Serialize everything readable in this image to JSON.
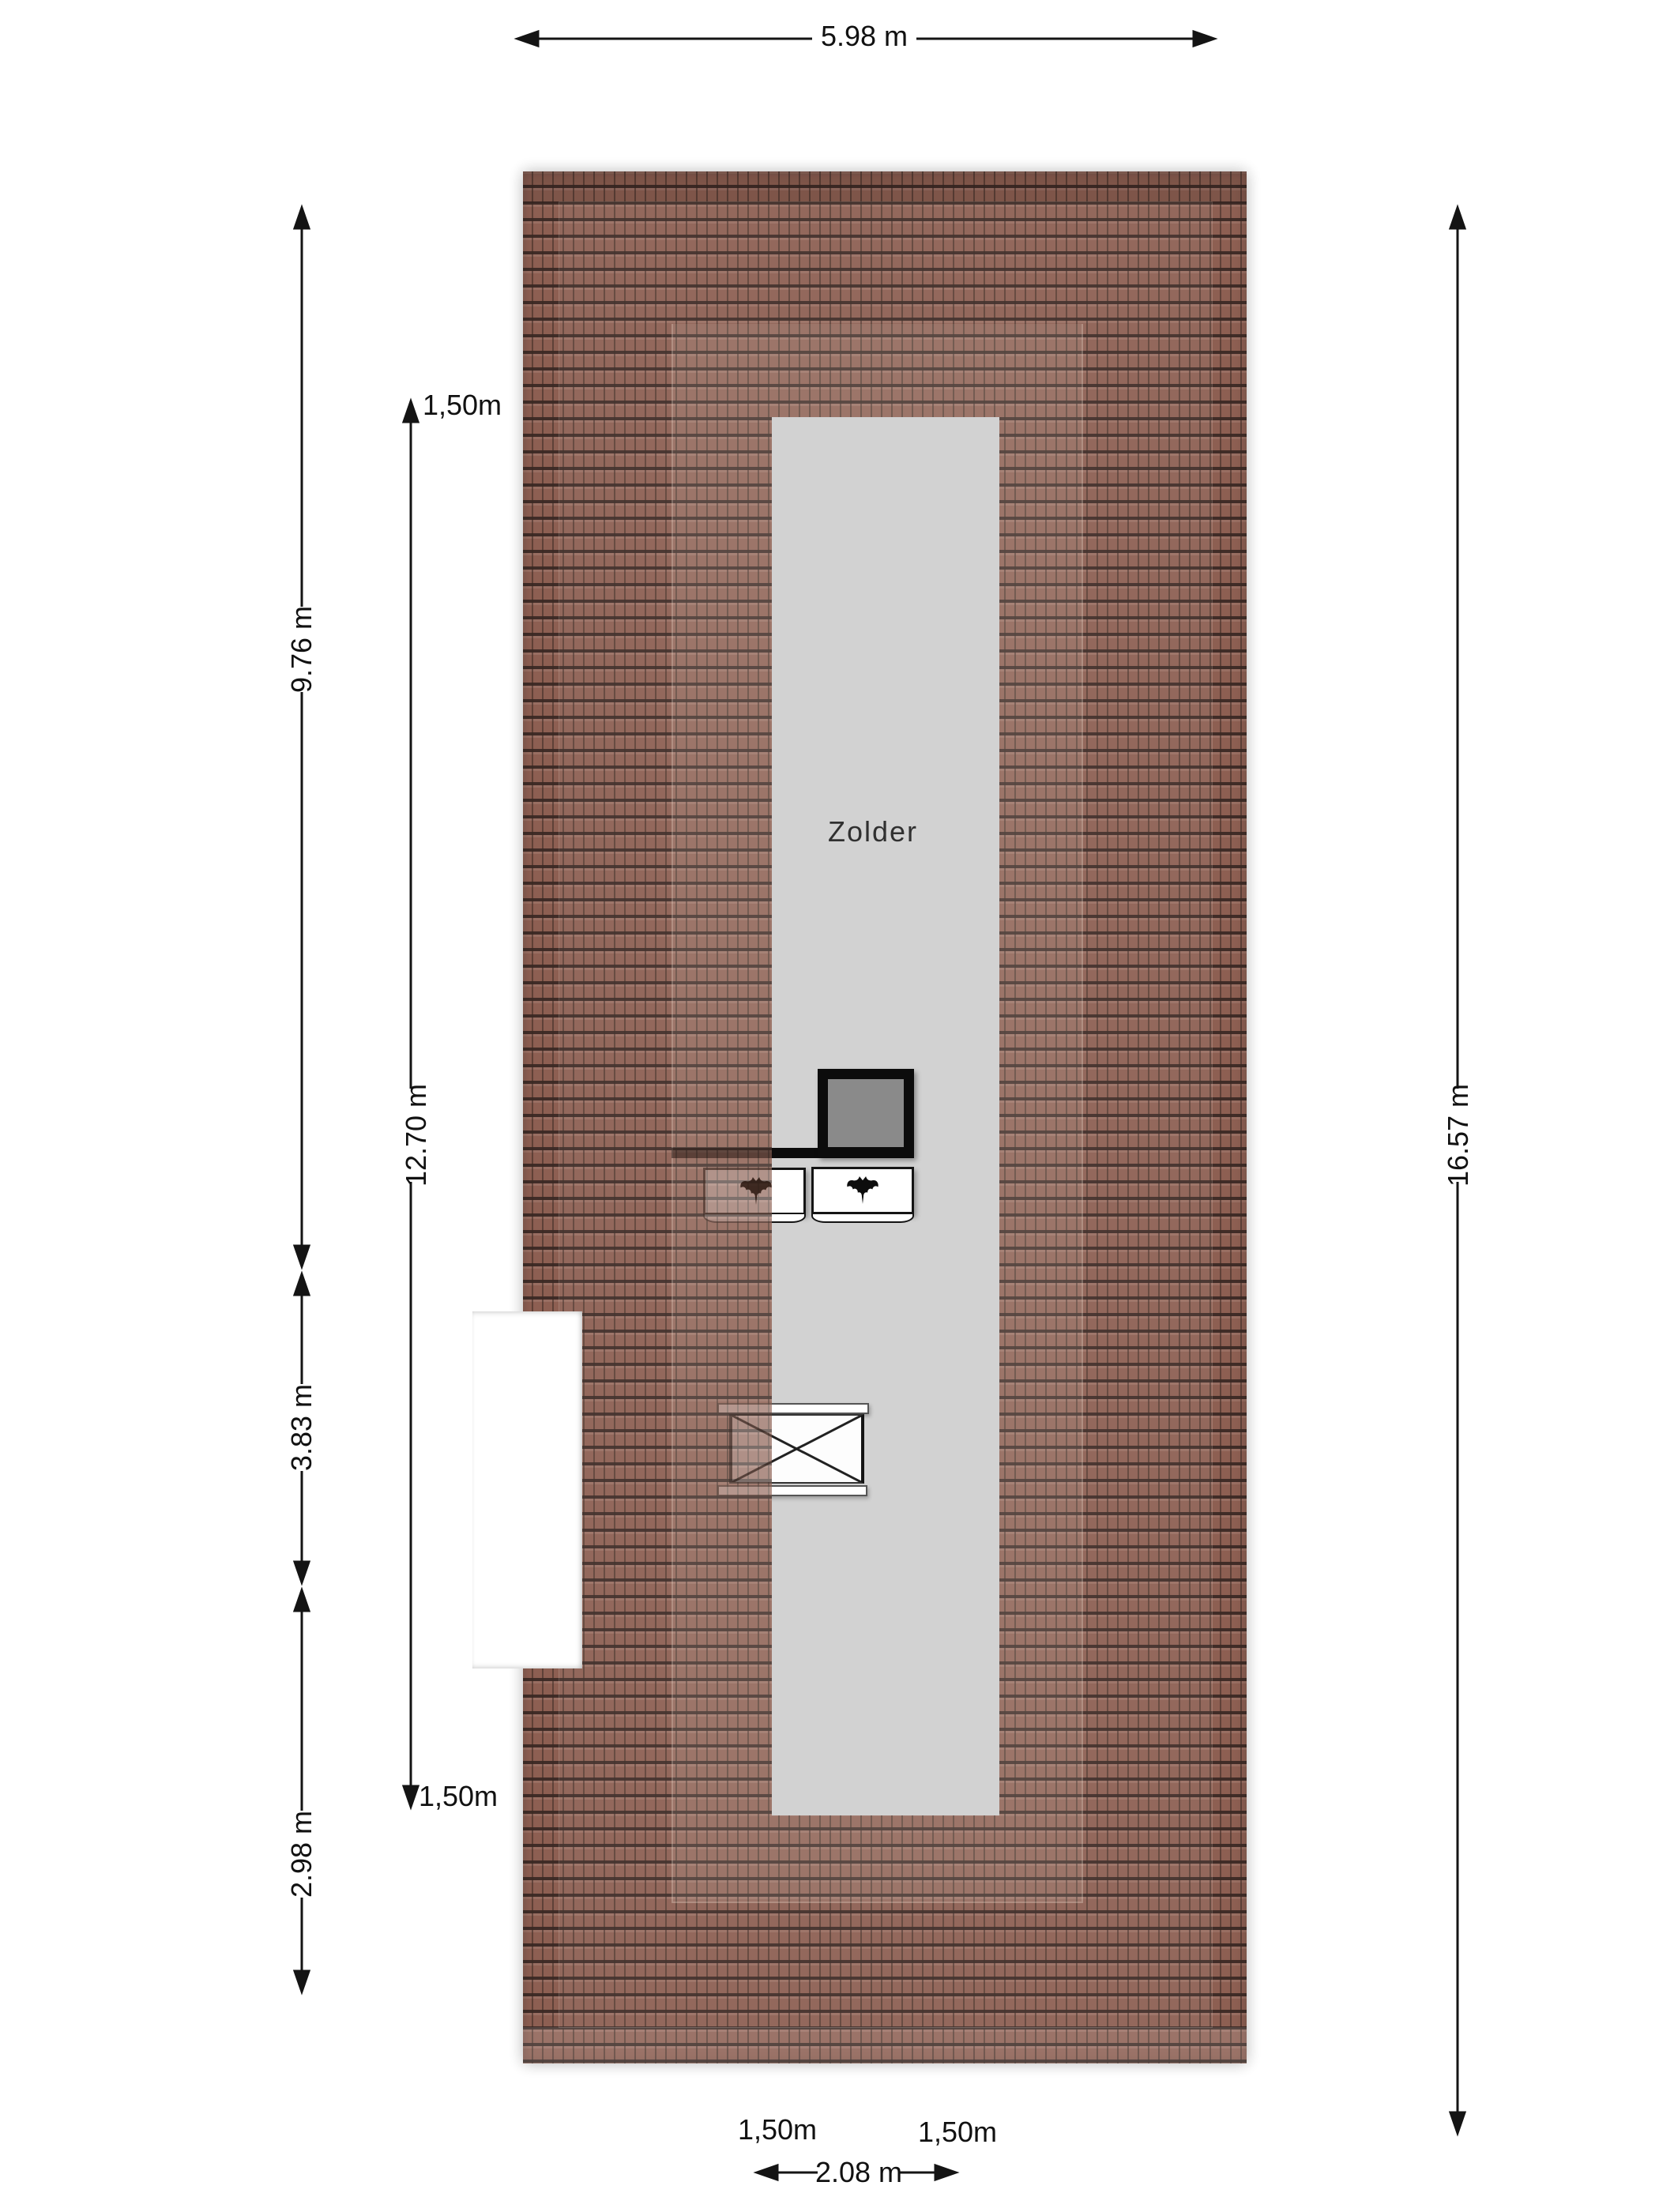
{
  "plan": {
    "room": {
      "label": "Zolder"
    },
    "dimensions": {
      "top_width": "5.98 m",
      "left_segments": [
        "9.76 m",
        "3.83 m",
        "2.98 m"
      ],
      "left_inner_span": "12.70 m",
      "left_inner_top_height": "1,50m",
      "left_inner_bottom_height": "1,50m",
      "right_height": "16.57 m",
      "bottom_span": "2.08 m",
      "bottom_left_height": "1,50m",
      "bottom_right_height": "1,50m"
    },
    "colors": {
      "roof_tile": "#845244",
      "tile_joint": "#2a1710",
      "room_gray": "#d2d2d2",
      "chimney_gray": "#8a8a8a",
      "line_black": "#141414",
      "background": "#ffffff"
    }
  }
}
